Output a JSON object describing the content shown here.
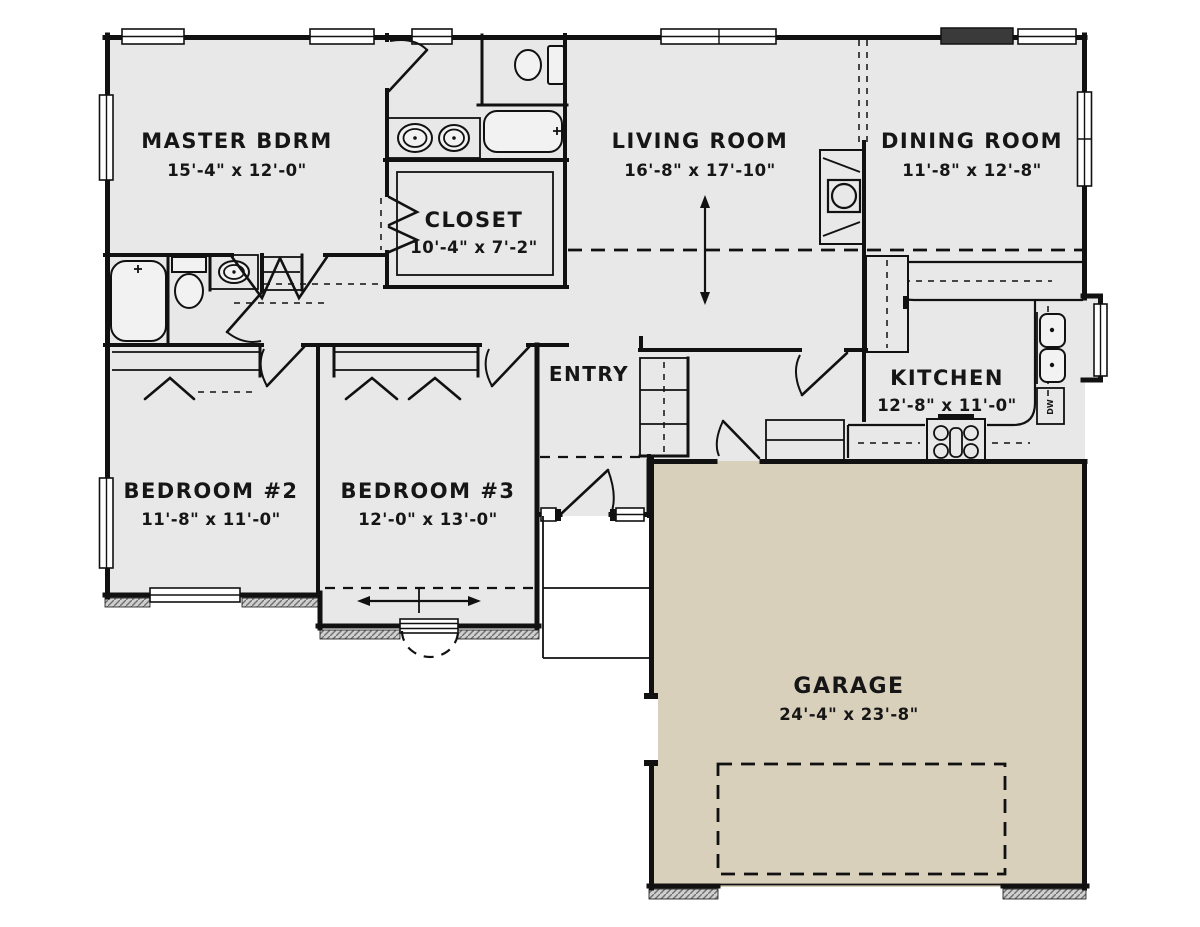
{
  "colors": {
    "background": "#ffffff",
    "floor": "#e8e8e8",
    "garage_floor": "#d9d0bc",
    "wall": "#111111",
    "text": "#161616"
  },
  "rooms": {
    "master": {
      "name": "MASTER BDRM",
      "dims": "15'-4\" x 12'-0\""
    },
    "closet": {
      "name": "CLOSET",
      "dims": "10'-4\" x 7'-2\""
    },
    "living": {
      "name": "LIVING ROOM",
      "dims": "16'-8\" x 17'-10\""
    },
    "dining": {
      "name": "DINING ROOM",
      "dims": "11'-8\" x 12'-8\""
    },
    "entry": {
      "name": "ENTRY"
    },
    "kitchen": {
      "name": "KITCHEN",
      "dims": "12'-8\" x 11'-0\""
    },
    "bedroom2": {
      "name": "BEDROOM #2",
      "dims": "11'-8\" x 11'-0\""
    },
    "bedroom3": {
      "name": "BEDROOM #3",
      "dims": "12'-0\" x 13'-0\""
    },
    "garage": {
      "name": "GARAGE",
      "dims": "24'-4\" x 23'-8\""
    }
  },
  "labels": {
    "dishwasher": "DW"
  }
}
